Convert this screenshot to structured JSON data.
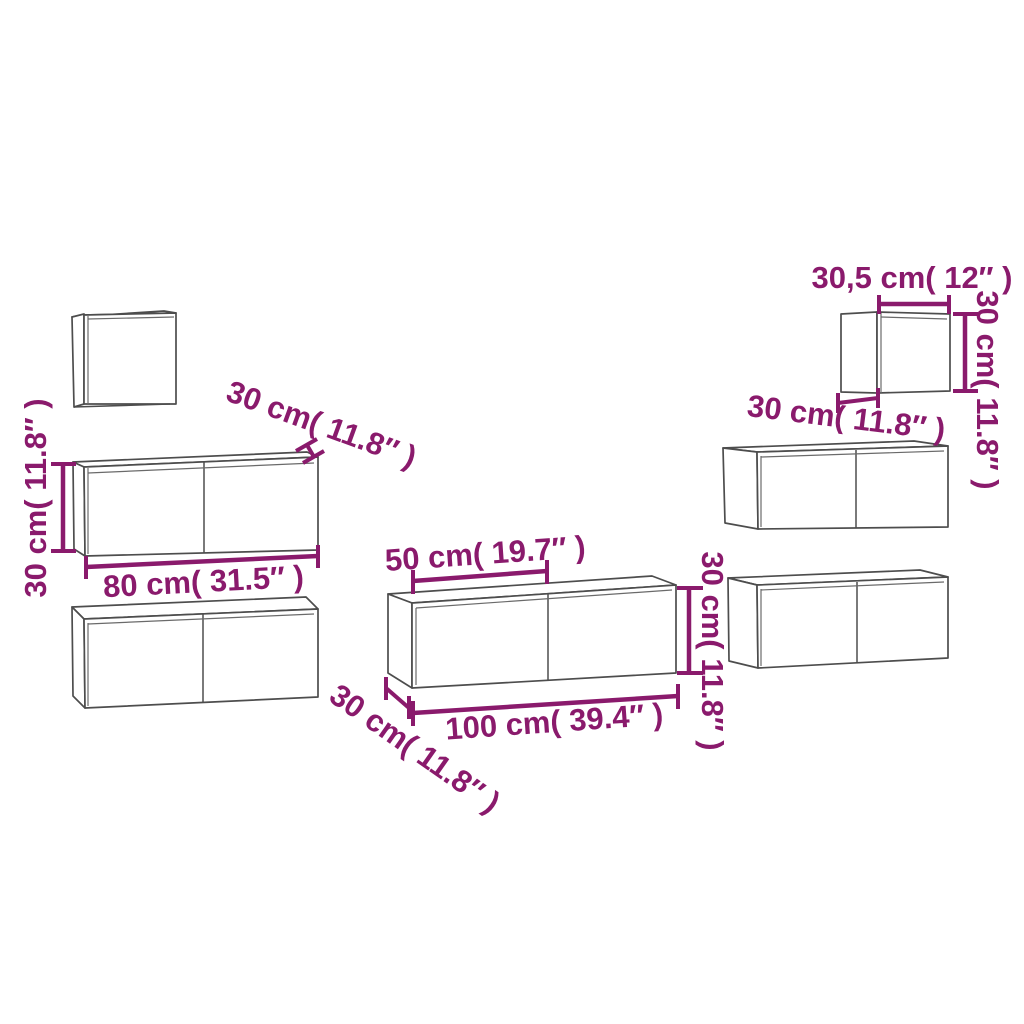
{
  "diagram": {
    "type": "furniture-dimension-diagram",
    "background": "#ffffff",
    "colors": {
      "dimension": "#8a1a6c",
      "outline": "#4d4d4d"
    },
    "annotations": {
      "left": {
        "height": "30 cm( 11.8″ )",
        "width": "80 cm( 31.5″ )",
        "depth": "30 cm( 11.8″ )"
      },
      "center": {
        "half_width": "50 cm( 19.7″ )",
        "width": "100 cm( 39.4″ )",
        "depth": "30 cm( 11.8″ )",
        "height": "30 cm( 11.8″ )"
      },
      "right_small": {
        "width": "30,5 cm( 12″ )",
        "height": "30 cm( 11.8″ )",
        "depth": "30 cm( 11.8″ )"
      }
    }
  }
}
